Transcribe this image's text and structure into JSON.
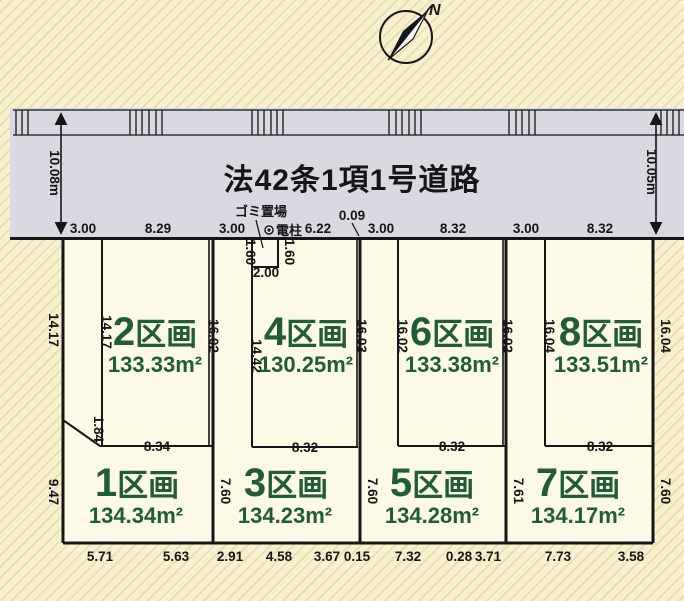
{
  "compass": {
    "north": "N"
  },
  "road": {
    "name": "法42条1項1号道路",
    "width_left": "10.08m",
    "width_right": "10.05m"
  },
  "garbage": {
    "label": "ゴミ置場",
    "side_left": "1.60",
    "side_right": "1.60",
    "width": "2.00"
  },
  "pole": {
    "label": "電柱"
  },
  "labels": {
    "kukaku": "区画"
  },
  "top_dims": [
    "3.00",
    "8.29",
    "3.00",
    "6.22",
    "0.09",
    "3.00",
    "8.32",
    "3.00",
    "8.32"
  ],
  "bottom_dims": [
    "5.71",
    "5.63",
    "2.91",
    "4.58",
    "3.67",
    "0.15",
    "7.32",
    "0.28",
    "3.71",
    "7.73",
    "3.58"
  ],
  "left_dims": {
    "upper": "14.17",
    "lower": "9.47"
  },
  "divider_dims": {
    "d13": "7.60",
    "d35": "7.60",
    "d57": "7.61",
    "right": "7.60"
  },
  "plots": {
    "p1": {
      "num": "1",
      "area": "134.34m²"
    },
    "p2": {
      "num": "2",
      "area": "133.33m²",
      "left": "14.17",
      "left2": "1.84",
      "right": "16.02",
      "bottom": "8.34"
    },
    "p3": {
      "num": "3",
      "area": "134.23m²"
    },
    "p4": {
      "num": "4",
      "area": "130.25m²",
      "left": "14.42",
      "right": "16.03",
      "bottom": "8.32"
    },
    "p5": {
      "num": "5",
      "area": "134.28m²"
    },
    "p6": {
      "num": "6",
      "area": "133.38m²",
      "left": "16.02",
      "right": "16.02",
      "bottom": "8.32"
    },
    "p7": {
      "num": "7",
      "area": "134.17m²"
    },
    "p8": {
      "num": "8",
      "area": "133.51m²",
      "left": "16.04",
      "right": "16.04",
      "bottom": "8.32"
    }
  }
}
